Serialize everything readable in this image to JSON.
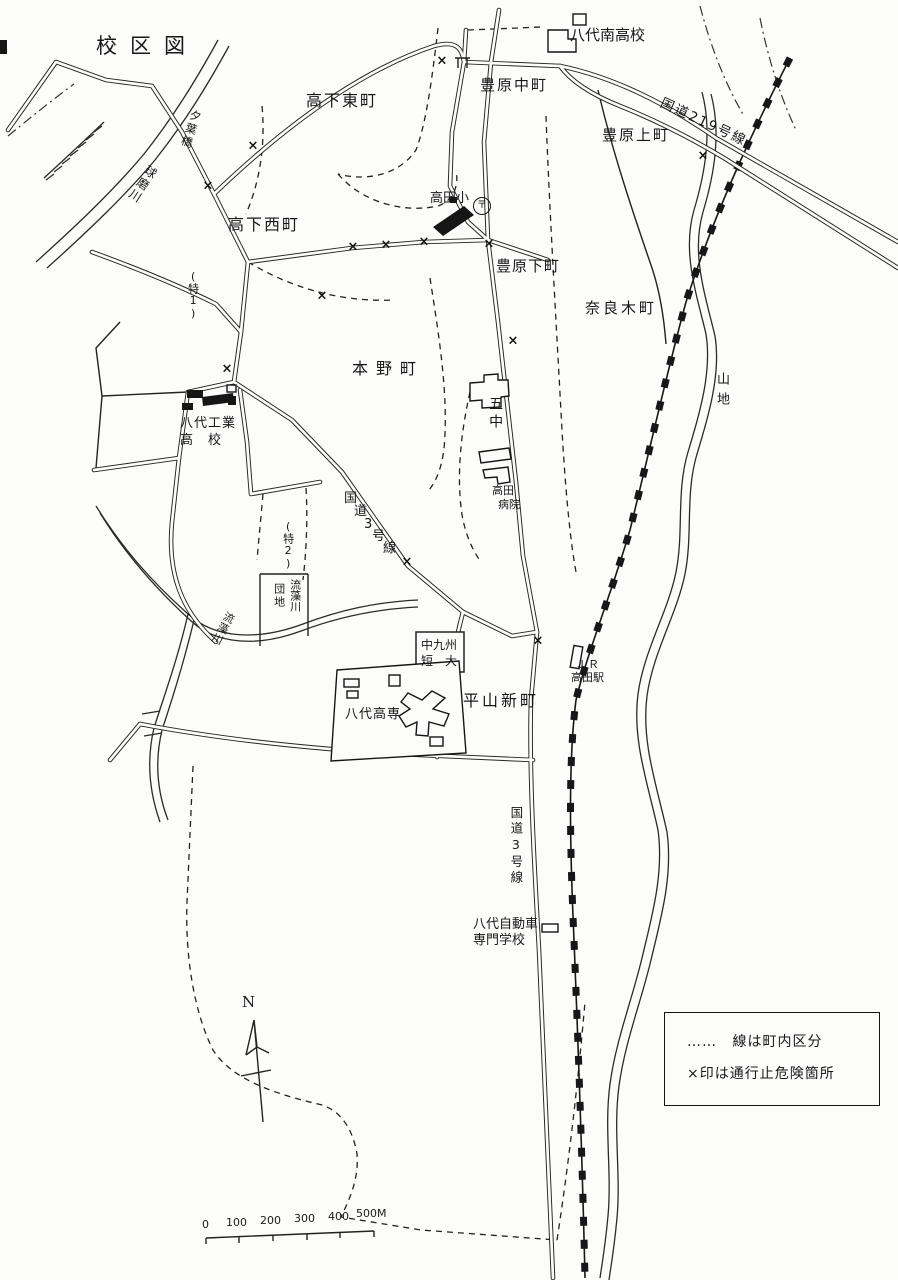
{
  "title": "校区図",
  "compass": {
    "label": "N"
  },
  "legend": {
    "line1_symbol": "……",
    "line1_text": "線は町内区分",
    "line2_text": "×印は通行止危険箇所"
  },
  "scale": {
    "ticks": [
      "0",
      "100",
      "200",
      "300",
      "400",
      "500M"
    ]
  },
  "towns": {
    "koge_higashi": "高下東町",
    "koge_nishi": "高下西町",
    "toyohara_naka": "豊原中町",
    "toyohara_kami": "豊原上町",
    "toyohara_shimo": "豊原下町",
    "naragi": "奈良木町",
    "motono": "本野町",
    "hirayama": "平山新町"
  },
  "schools": {
    "minami_high": "八代南高校",
    "takada_elem": "高田小",
    "kogyo_line1": "八代工業",
    "kogyo_line2": "高　校",
    "gochu": "五中",
    "kosen": "八代高専",
    "tandai_line1": "中九州",
    "tandai_line2": "短　大",
    "jidosha_line1": "八代自動車",
    "jidosha_line2": "専門学校"
  },
  "roads": {
    "route219": "国道219号線",
    "route3_diag_chars": [
      "国",
      "道",
      "3",
      "号",
      "線"
    ],
    "route3_south": "国道3号線"
  },
  "rivers": {
    "kuma": "球磨川",
    "ryuso": "流藻川",
    "bridge": "夕葉橋"
  },
  "places": {
    "danchi_col_right": "流藻川",
    "danchi_col_left": "団地",
    "hospital_line1": "高田",
    "hospital_line2": "病院",
    "station_line1": "ＪＲ",
    "station_line2": "高田駅",
    "mountain": "山地",
    "toku1": "(特1)",
    "toku2": "(特2)"
  },
  "symbols": {
    "x_mark": "×",
    "post_office": "〒"
  }
}
